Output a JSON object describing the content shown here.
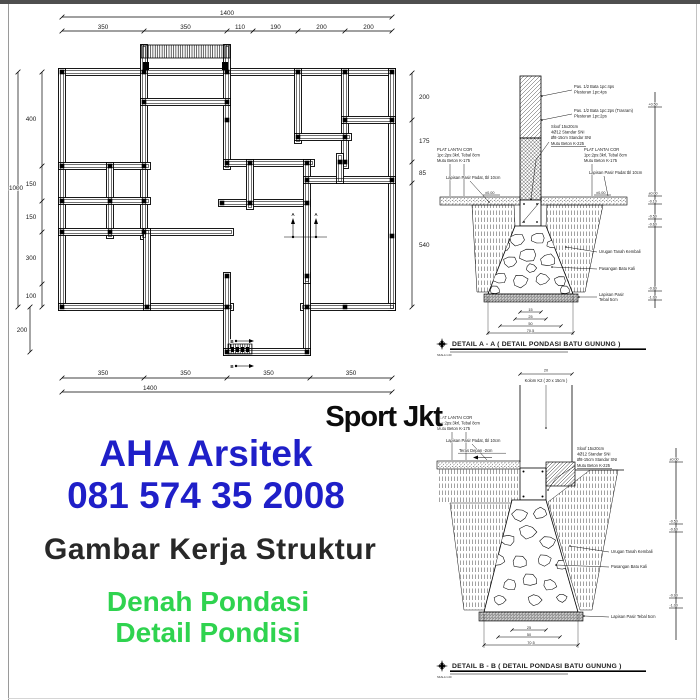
{
  "branding": {
    "watermark": "Sport Jkt",
    "company": "AHA Arsitek",
    "phone": "081 574 35 2008",
    "subtitle": "Gambar Kerja Struktur",
    "product_line1": "Denah Pondasi",
    "product_line2": "Detail Pondisi",
    "colors": {
      "blue": "#1f1fc8",
      "green": "#2fd34f",
      "dark": "#282828"
    }
  },
  "plan": {
    "total_width": "1400",
    "top_segments": [
      "350",
      "350",
      "110",
      "190",
      "200",
      "200"
    ],
    "total_height": "1000",
    "left_segments": [
      "400",
      "150",
      "150",
      "300",
      "100"
    ],
    "left_lower": "200",
    "right_segments": [
      "200",
      "175",
      "85",
      "540"
    ],
    "bottom_segments": [
      "350",
      "350",
      "350",
      "350"
    ],
    "total_width_bottom": "1400",
    "marker_a": "A",
    "marker_b": "B"
  },
  "detail_a": {
    "caption": "DETAIL A - A ( DETAIL PONDASI BATU GUNUNG )",
    "scale": "SKALA 1:20",
    "icons": {
      "caption_marker": "compass-star"
    },
    "labels": {
      "bata": [
        "Pas. 1/2 Bata 1pc:4ps",
        "Plesteran 1pc:4ps"
      ],
      "trasram": [
        "Pas. 1/2 Bata 1pc:2ps (Trasram)",
        "Plesteran 1pc:2ps"
      ],
      "sloof": [
        "Sloof 15x20cm",
        "4Ø12 Standar SNI",
        "Ø8-15cm Standar SNI",
        "Mutu Beton K-225"
      ],
      "plat_left": [
        "PLAT LANTAI COR",
        "1pc:2ps:3krl, Tebal 8cm",
        "Mutu Beton K-175"
      ],
      "pasir_left": "Lapisan Pasir Padat, tbl 10cm",
      "plat_right": [
        "PLAT LANTAI COR",
        "1pc:2ps:3krl, Tebal 8cm",
        "Mutu Beton K-175"
      ],
      "pasir_right": "Lapisan Pasir Padat tbl 10cm",
      "urugan": "Urugan Tanah Kembali",
      "batu": "Pasangan Batu Kali",
      "pasir_bawah": [
        "Lapisan Pasir",
        "Tebal 5cm"
      ]
    },
    "floor_level": "±0.00",
    "elevations": [
      "+0.50",
      "±0.00",
      "-0.10",
      "-0.50",
      "-0.60",
      "-0.90",
      "-1.00"
    ],
    "dims": [
      "15",
      "25",
      "50",
      "70,5"
    ]
  },
  "detail_b": {
    "caption": "DETAIL B - B ( DETAIL PONDASI BATU GUNUNG )",
    "scale": "SKALA 1:20",
    "icons": {
      "caption_marker": "compass-star"
    },
    "col_dim": "20",
    "labels": {
      "kolom": "Kolom K2 ( 20 x 15cm )",
      "plat": [
        "PLAT LANTAI COR",
        "1pc:2ps:3krl, Tebal 8cm",
        "Mutu Beton K-175"
      ],
      "pasir": "Lapisan Pasir Padat, tbl 10cm",
      "teras": "Teras Depan -2cm",
      "sloof": [
        "Sloof 15x20cm",
        "4Ø12 Standar SNI",
        "Ø8-15cm Standar SNI",
        "Mutu Beton K-225"
      ],
      "urugan": "Urugan Tanah Kembali",
      "batu": "Pasangan Batu Kali",
      "pasir_bawah": "Lapisan Pasir Tebal 5cm"
    },
    "elevations": [
      "±0.00",
      "-0.50",
      "-0.60",
      "-0.90",
      "-1.00"
    ],
    "dims": [
      "25",
      "50",
      "70,5"
    ]
  }
}
